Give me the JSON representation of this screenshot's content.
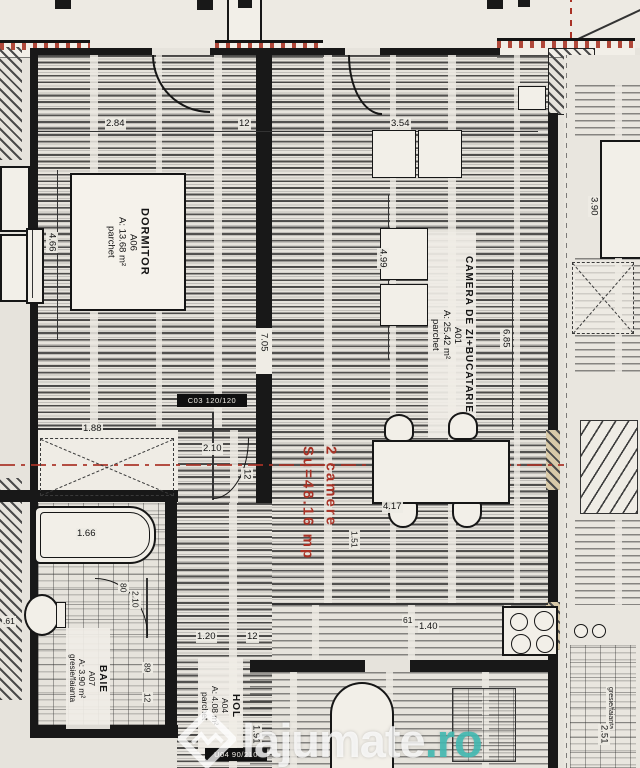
{
  "plan": {
    "summary": {
      "line1": "2 camere",
      "line2": "Su=48.16 mp"
    },
    "rooms": {
      "dormitor": {
        "name": "DORMITOR",
        "code": "A06",
        "area": "A: 13.68 m²",
        "finish": "parchet"
      },
      "living": {
        "name": "CAMERA DE ZI+BUCATARIE",
        "code": "A01",
        "area": "A: 25.42 m²",
        "finish": "parchet"
      },
      "baie": {
        "name": "BAIE",
        "code": "A07",
        "area": "A: 3.90 m²",
        "finish": "gresie/faianta"
      },
      "hol": {
        "name": "HOL",
        "code": "A04",
        "area": "A: 4.08 m²",
        "finish": "parchet"
      },
      "neighbor": {
        "finish": "gresie/faianta"
      }
    },
    "dims": {
      "d284": "2.84",
      "d12a": "12",
      "d354": "3.54",
      "d466": "4.66",
      "d499": "4.99",
      "d705": "7.05",
      "d685": "6.85",
      "d390": "3.90",
      "d188": "1.88",
      "d210a": "2.10",
      "d12b": "12",
      "d166": "1.66",
      "d80": "80",
      "d210b": "2.10",
      "d120": "1.20",
      "d12c": "12",
      "d89": "89",
      "d12d": "12",
      "d61a": "61",
      "d140": "1.40",
      "d417": "4.17",
      "d151": "1.51",
      "d191": "1.91",
      "d251": "2.51",
      "d61b": ".61"
    },
    "tags": {
      "window": "C03 120/120",
      "door": "U04 90/210"
    },
    "colors": {
      "accent_red": "#a93226",
      "watermark_teal": "#40bab2"
    }
  },
  "watermark": {
    "name": "lajumate",
    "tld": ".ro"
  }
}
